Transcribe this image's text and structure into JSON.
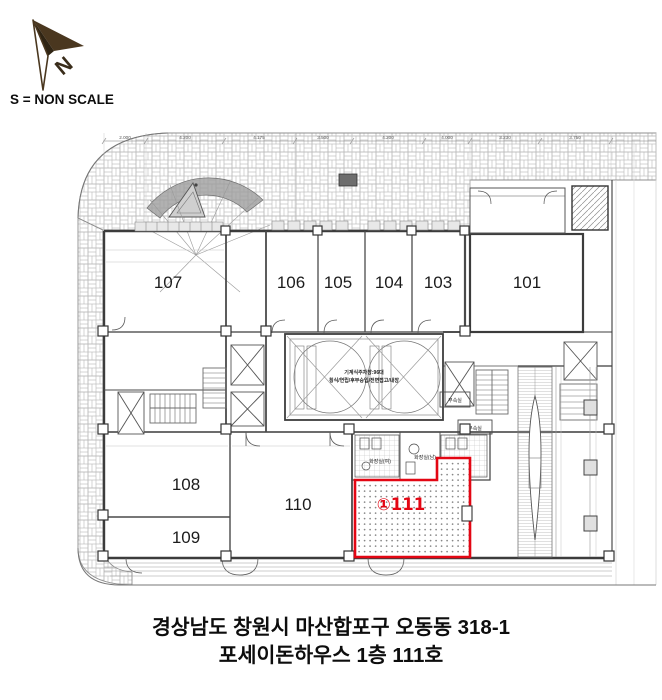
{
  "header": {
    "north_label": "N",
    "scale_note": "S = NON SCALE"
  },
  "plan": {
    "dimensions": [
      "2.000",
      "4.200",
      "4.175",
      "3.500",
      "4.200",
      "4.000",
      "3.230",
      "3.750"
    ],
    "rooms": [
      {
        "label": "107"
      },
      {
        "label": "106"
      },
      {
        "label": "105"
      },
      {
        "label": "104"
      },
      {
        "label": "103"
      },
      {
        "label": "101"
      },
      {
        "label": "108"
      },
      {
        "label": "109"
      },
      {
        "label": "110"
      }
    ],
    "highlight": {
      "label": "①111",
      "color": "#e30613"
    },
    "parking": {
      "line1": "기계식주차장:96대",
      "line2": "횡식/연립/후부승입/전면접고/내장"
    },
    "annotations": {
      "annex1": "부속실",
      "annex2": "부속실",
      "toilet_w": "화장실(여)",
      "toilet_m": "화장실(남)"
    }
  },
  "caption": {
    "line1": "경상남도 창원시 마산합포구 오동동 318-1",
    "line2": "포세이돈하우스 1층 111호"
  }
}
